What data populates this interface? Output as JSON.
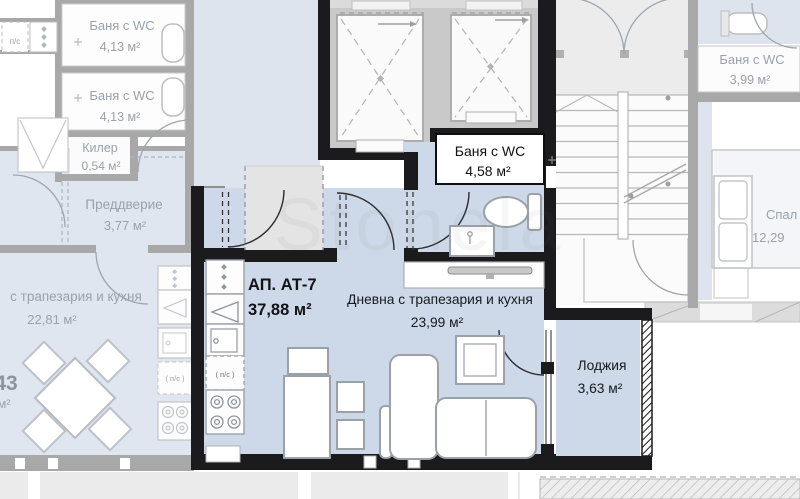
{
  "watermark": {
    "text": "Stonela"
  },
  "featured": {
    "id": "АП. АТ-7",
    "area": "37,88 м²",
    "living_name": "Дневна с трапезария и кухня",
    "living_area": "23,99 м²",
    "bath_name": "Баня с WC",
    "bath_area": "4,58 м²",
    "loggia_name": "Лоджия",
    "loggia_area": "3,63 м²",
    "washer": "( п/с )"
  },
  "left": {
    "bath1_name": "Баня с WC",
    "bath1_area": "4,13 м²",
    "bath2_name": "Баня с WC",
    "bath2_area": "4,13 м²",
    "closet_name": "Килер",
    "closet_area": "0,54 м²",
    "vestibule_name": "Преддверие",
    "vestibule_area": "3,77 м²",
    "living_name": "с трапезария и кухня",
    "living_area": "22,81 м²",
    "number_partial": "43",
    "unit_partial": "м²",
    "washer": "( п/с )",
    "washer_top": "п/с"
  },
  "right": {
    "bath_name": "Баня с WC",
    "bath_area": "3,99 м²",
    "bedroom_name": "Спал",
    "bedroom_area": "12,29"
  },
  "colors": {
    "featured_fill": "#cdd9e8",
    "faded_fill": "#e0e6ef",
    "lobby_fill": "#dde4ee",
    "wall_black": "#1b1b1d",
    "wall_gray": "#a8a8a8",
    "faded_text": "#9aa1ac",
    "dark_text": "#17191d"
  }
}
